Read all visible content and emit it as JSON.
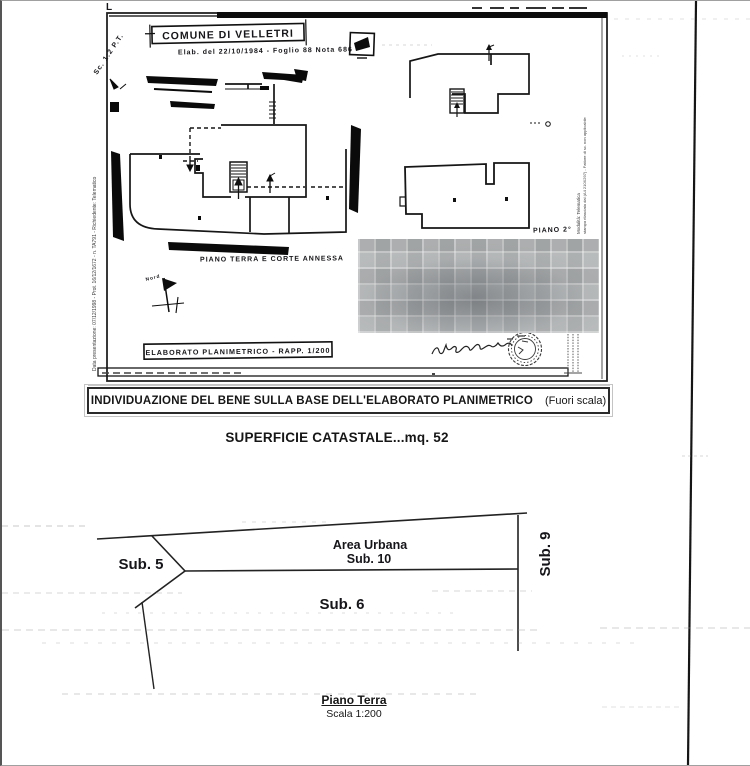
{
  "plan_sheet": {
    "corner_mark": "L",
    "handwritten_note": "Sc. 1:2 P.T.",
    "comune_title": "COMUNE DI VELLETRI",
    "protocol_line": "Elab. del 22/10/1984 - Foglio 88 Nota 686",
    "left_margin": "Data presentazione: 07/12/1998 - Prot. 16/12/1672 - n. TA791 - Richiedente: Telematico",
    "right_margin_line1": "Modalità: Telematica",
    "right_margin_line2": "stampa rilasciata dal (A4 210X297) - Fattore di sc. non applicabile",
    "north_label": "Nord",
    "ground_floor_label": "PIANO TERRA E CORTE ANNESSA",
    "elaborato_label": "ELABORATO PLANIMETRICO - RAPP. 1/200",
    "second_floor_label": "PIANO 2°"
  },
  "caption": {
    "main": "INDIVIDUAZIONE DEL BENE SULLA BASE DELL'ELABORATO PLANIMETRICO",
    "note": "(Fuori scala)"
  },
  "surface_line": "SUPERFICIE CATASTALE...mq. 52",
  "subdivision_diagram": {
    "sub5": "Sub. 5",
    "area_urbana": "Area Urbana",
    "sub10": "Sub. 10",
    "sub6": "Sub. 6",
    "sub9": "Sub. 9"
  },
  "footer": {
    "floor": "Piano Terra",
    "scale": "Scala 1:200"
  },
  "colors": {
    "ink": "#1a1a1a",
    "scan_artifact": "#9a9a9a",
    "censor_gray": "#c9cbcc"
  }
}
